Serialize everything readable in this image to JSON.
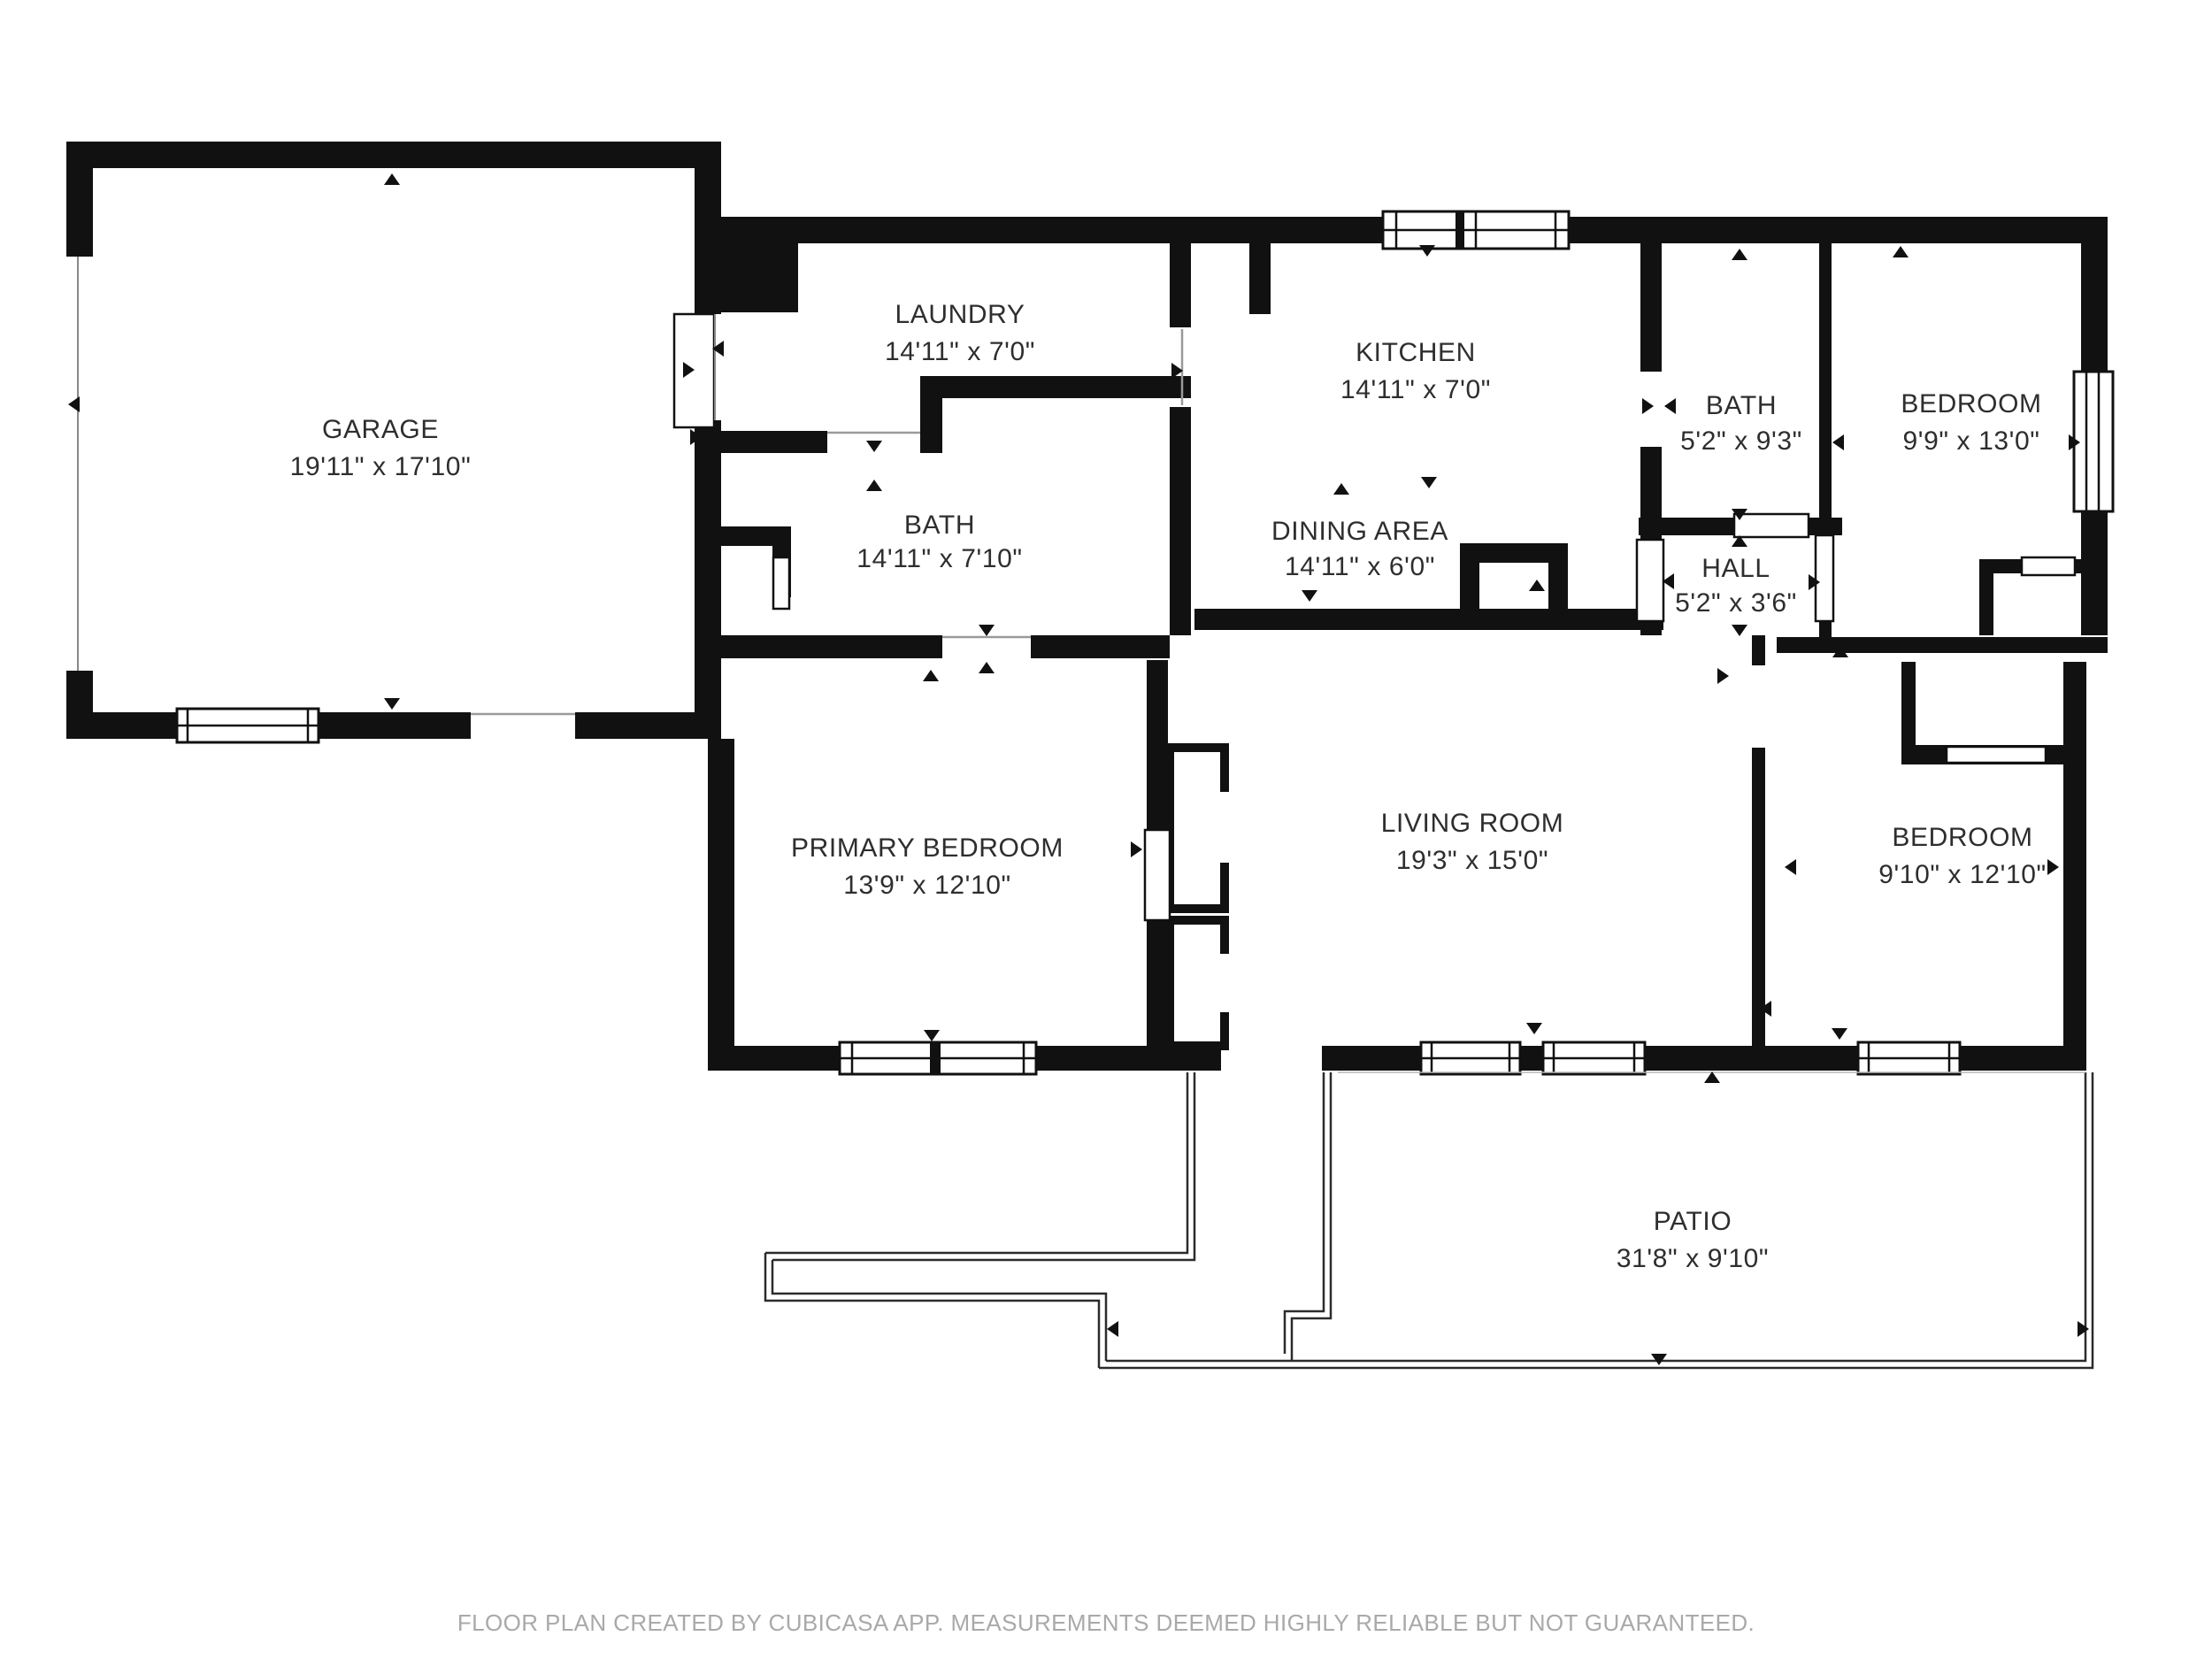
{
  "meta": {
    "app": "CubiCasa floor plan",
    "background": "#ffffff",
    "wall_color": "#111111",
    "label_color": "#2e2e2e",
    "footer_color": "#a9a9a9"
  },
  "rooms": [
    {
      "id": "garage",
      "name": "GARAGE",
      "dims": "19'11\" x 17'10\""
    },
    {
      "id": "laundry",
      "name": "LAUNDRY",
      "dims": "14'11\" x 7'0\""
    },
    {
      "id": "kitchen",
      "name": "KITCHEN",
      "dims": "14'11\" x 7'0\""
    },
    {
      "id": "bath-main",
      "name": "BATH",
      "dims": "14'11\" x 7'10\""
    },
    {
      "id": "dining-area",
      "name": "DINING AREA",
      "dims": "14'11\" x 6'0\""
    },
    {
      "id": "bath-small",
      "name": "BATH",
      "dims": "5'2\" x 9'3\""
    },
    {
      "id": "bedroom-top",
      "name": "BEDROOM",
      "dims": "9'9\" x 13'0\""
    },
    {
      "id": "hall",
      "name": "HALL",
      "dims": "5'2\" x 3'6\""
    },
    {
      "id": "primary-bedroom",
      "name": "PRIMARY BEDROOM",
      "dims": "13'9\" x 12'10\""
    },
    {
      "id": "living-room",
      "name": "LIVING ROOM",
      "dims": "19'3\" x 15'0\""
    },
    {
      "id": "bedroom-bottom",
      "name": "BEDROOM",
      "dims": "9'10\" x 12'10\""
    },
    {
      "id": "patio",
      "name": "PATIO",
      "dims": "31'8\" x 9'10\""
    }
  ],
  "footer": {
    "text": "FLOOR PLAN CREATED BY CUBICASA APP. MEASUREMENTS DEEMED HIGHLY RELIABLE BUT NOT GUARANTEED."
  }
}
